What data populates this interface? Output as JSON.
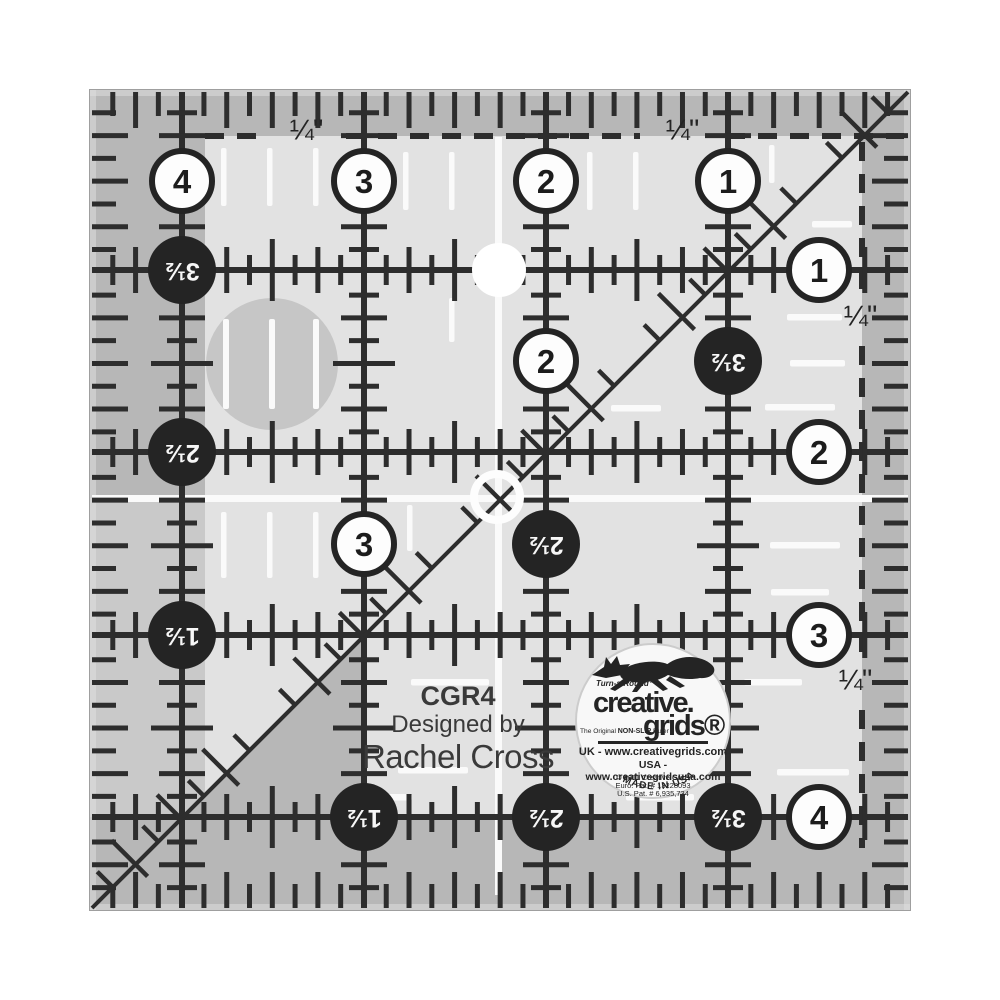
{
  "product": {
    "model": "CGR4",
    "designed_by": "Designed by",
    "designer": "Rachel Cross"
  },
  "ruler": {
    "quarter_label": "¼\"",
    "top_circles": [
      {
        "value": "4"
      },
      {
        "value": "3"
      },
      {
        "value": "2"
      },
      {
        "value": "1"
      }
    ],
    "right_circles": [
      {
        "value": "1"
      },
      {
        "value": "2"
      },
      {
        "value": "3"
      },
      {
        "value": "4"
      }
    ],
    "left_circles": [
      {
        "value": "3½"
      },
      {
        "value": "2½"
      },
      {
        "value": "1½"
      }
    ],
    "bottom_circles": [
      {
        "value": "1½"
      },
      {
        "value": "2½"
      },
      {
        "value": "3½"
      }
    ],
    "inner_white_circles": [
      {
        "value": "2"
      },
      {
        "value": "3"
      }
    ],
    "inner_black_circles": [
      {
        "value": "3½"
      },
      {
        "value": "2½"
      }
    ]
  },
  "logo": {
    "turnaround": "Turn-a-Round™",
    "script_top": "creative.",
    "script_bottom": "grids®",
    "tagline_1": "The Original ",
    "tagline_2": "NON-SLIP",
    "tagline_3": " Ruler",
    "uk_line": "UK - www.creativegrids.com",
    "usa_line": "USA - www.creativegridsusa.com",
    "copyright": "© 2011 Creative Grids",
    "euro_pat": "Euro. Pat. # 13228093",
    "us_pat": "U.S. Pat. # 6,935,734",
    "made_in": "MADE IN USA"
  },
  "colors": {
    "ink": "#2d2d2d",
    "circle_black": "#242424",
    "ruler_light": "#e2e2e2",
    "ruler_dark": "#b7b7b7",
    "grip_white": "#fafafa"
  }
}
